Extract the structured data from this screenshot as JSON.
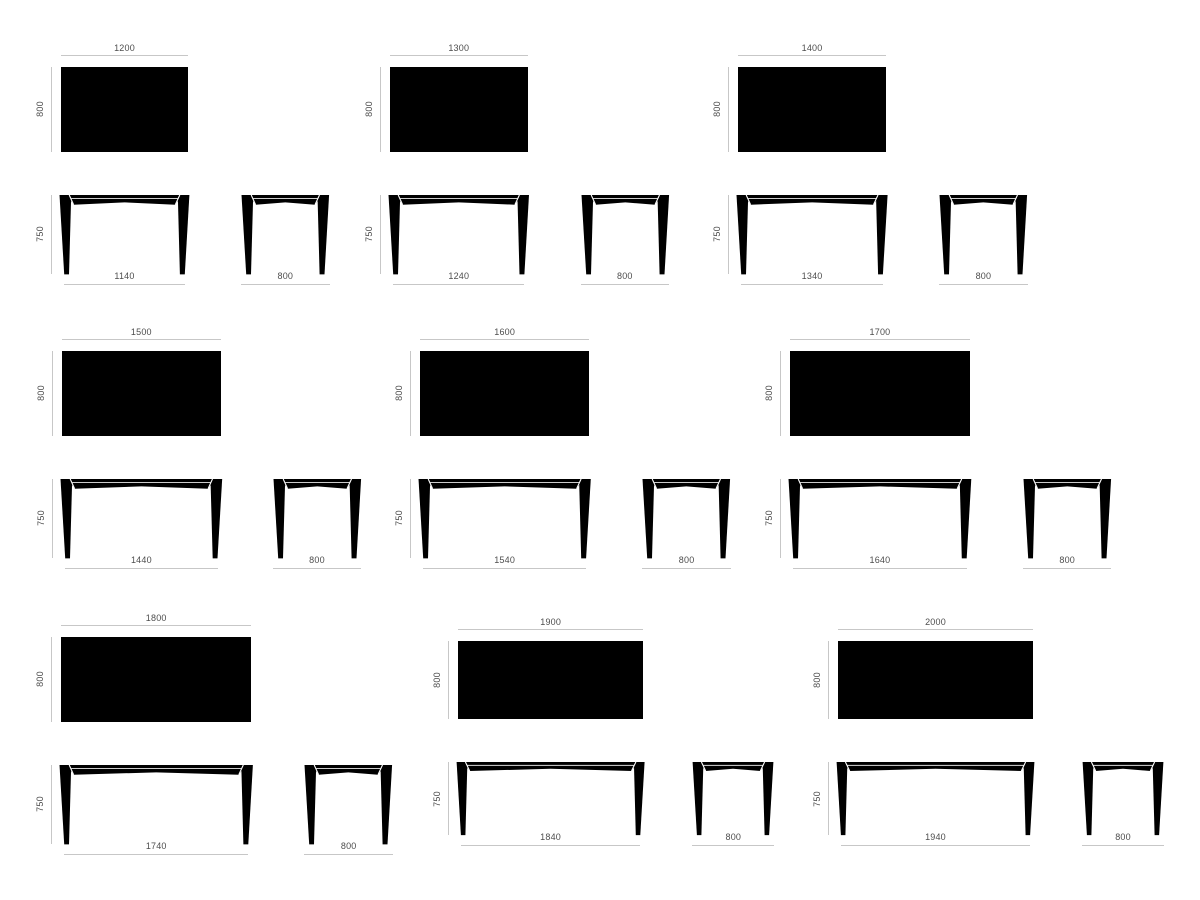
{
  "drawing": {
    "background": "#ffffff",
    "shape_color": "#000000",
    "dim_line_color": "#c7c7c7",
    "dim_text_color": "#4d4d4d"
  },
  "tables": [
    {
      "top_width": "1200",
      "top_depth": "800",
      "front_height": "750",
      "front_width": "1140",
      "side_width": "800"
    },
    {
      "top_width": "1300",
      "top_depth": "800",
      "front_height": "750",
      "front_width": "1240",
      "side_width": "800"
    },
    {
      "top_width": "1400",
      "top_depth": "800",
      "front_height": "750",
      "front_width": "1340",
      "side_width": "800"
    },
    {
      "top_width": "1500",
      "top_depth": "800",
      "front_height": "750",
      "front_width": "1440",
      "side_width": "800"
    },
    {
      "top_width": "1600",
      "top_depth": "800",
      "front_height": "750",
      "front_width": "1540",
      "side_width": "800"
    },
    {
      "top_width": "1700",
      "top_depth": "800",
      "front_height": "750",
      "front_width": "1640",
      "side_width": "800"
    },
    {
      "top_width": "1800",
      "top_depth": "800",
      "front_height": "750",
      "front_width": "1740",
      "side_width": "800"
    },
    {
      "top_width": "1900",
      "top_depth": "800",
      "front_height": "750",
      "front_width": "1840",
      "side_width": "800"
    },
    {
      "top_width": "2000",
      "top_depth": "800",
      "front_height": "750",
      "front_width": "1940",
      "side_width": "800"
    }
  ]
}
